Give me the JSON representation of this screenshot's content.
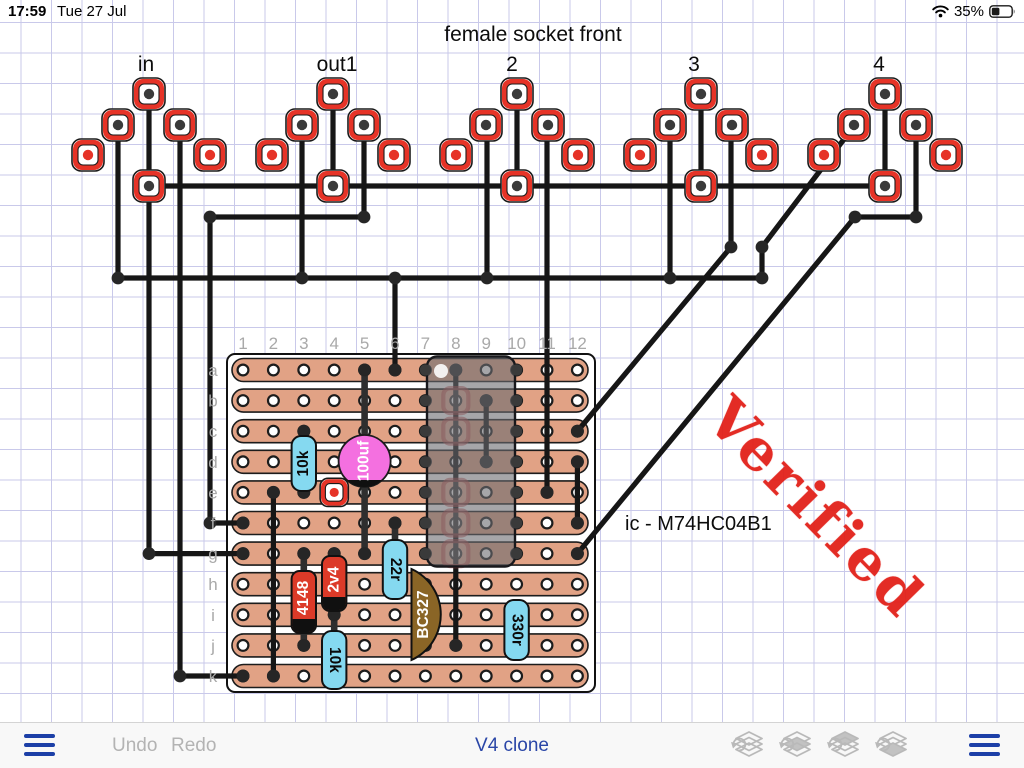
{
  "status_bar": {
    "time": "17:59",
    "date": "Tue 27 Jul",
    "battery_percent": "35%",
    "battery_level": 0.35
  },
  "header": {
    "title": "female socket front",
    "title_x": 533,
    "title_y": 41,
    "socket_labels": [
      {
        "text": "in",
        "x": 146
      },
      {
        "text": "out1",
        "x": 337
      },
      {
        "text": "2",
        "x": 512
      },
      {
        "text": "3",
        "x": 694
      },
      {
        "text": "4",
        "x": 879
      }
    ],
    "labels_y": 71
  },
  "annotations": {
    "ic_label": {
      "text": "ic - M74HC04B1",
      "x": 625,
      "y": 530
    },
    "stamp": {
      "text": "Verified",
      "color": "#e2211a",
      "angle": 45.5
    }
  },
  "toolbar": {
    "undo_label": "Undo",
    "redo_label": "Redo",
    "title": "V4 clone",
    "layer_buttons": [
      {
        "name": "layer-raise-to-top",
        "filled": -1
      },
      {
        "name": "layer-raise",
        "filled": 1
      },
      {
        "name": "layer-lower",
        "filled": 0
      },
      {
        "name": "layer-lower-to-bottom",
        "filled": 2
      }
    ]
  },
  "colors": {
    "grid": "#c9c9ea",
    "wire": "#161616",
    "lead": "#2e2e2e",
    "pad_red": "#e63327",
    "dot_dark": "#3a3a3a",
    "junction": "#262626",
    "strip": "#e1a285",
    "strip_edge": "#1c1c1c",
    "cyan": "#85d9f0",
    "comp_red": "#dc3a28",
    "cap_pink": "#f470e0",
    "transistor_brown": "#8a6526",
    "ic_gray": "rgba(106,106,112,0.6)",
    "label_gray": "#a9a9a9",
    "blue": "#1c3fa7",
    "toolbar_gray": "#b3b3b3"
  },
  "board": {
    "x": 227,
    "y": 354,
    "w": 368,
    "h": 338,
    "cols": [
      243,
      273.4,
      303.8,
      334.2,
      364.6,
      395,
      425.4,
      455.8,
      486.2,
      516.6,
      547,
      577.4
    ],
    "rows": [
      370,
      400.6,
      431.2,
      461.8,
      492.4,
      523,
      553.6,
      584.2,
      614.8,
      645.4,
      676
    ],
    "col_labels": [
      "1",
      "2",
      "3",
      "4",
      "5",
      "6",
      "7",
      "8",
      "9",
      "10",
      "11",
      "12"
    ],
    "row_labels": [
      "a",
      "b",
      "c",
      "d",
      "e",
      "f",
      "g",
      "h",
      "i",
      "j",
      "k"
    ],
    "col_label_y": 349,
    "row_label_x": 213
  },
  "circuit": {
    "socket_groups": [
      {
        "label": "in",
        "cx": 149
      },
      {
        "label": "out1",
        "cx": 333
      },
      {
        "label": "2",
        "cx": 517
      },
      {
        "label": "3",
        "cx": 701
      },
      {
        "label": "4",
        "cx": 885
      }
    ],
    "socket_rows": {
      "top_y": 94,
      "flank_y": 125,
      "wide_y": 155,
      "bottom_y": 186,
      "flank_dx": 31,
      "wide_dx": 61
    },
    "wires": [
      [
        [
          149,
          186
        ],
        [
          885,
          186
        ]
      ],
      [
        [
          149,
          94
        ],
        [
          149,
          186
        ]
      ],
      [
        [
          333,
          94
        ],
        [
          333,
          186
        ]
      ],
      [
        [
          517,
          94
        ],
        [
          517,
          186
        ]
      ],
      [
        [
          701,
          94
        ],
        [
          701,
          186
        ]
      ],
      [
        [
          885,
          94
        ],
        [
          885,
          186
        ]
      ],
      [
        [
          118,
          125
        ],
        [
          118,
          278
        ]
      ],
      [
        [
          118,
          278
        ],
        [
          762,
          278
        ]
      ],
      [
        [
          302,
          125
        ],
        [
          302,
          278
        ]
      ],
      [
        [
          487,
          125
        ],
        [
          487,
          278
        ]
      ],
      [
        [
          670,
          125
        ],
        [
          670,
          278
        ]
      ],
      [
        [
          395,
          278
        ],
        [
          395,
          370
        ]
      ],
      [
        [
          854,
          126
        ],
        [
          762,
          247
        ],
        [
          762,
          278
        ]
      ],
      [
        [
          364,
          125
        ],
        [
          364,
          217
        ],
        [
          210,
          217
        ],
        [
          210,
          523
        ],
        [
          243,
          523
        ]
      ],
      [
        [
          180,
          125
        ],
        [
          180,
          676
        ],
        [
          243,
          676
        ]
      ],
      [
        [
          149,
          186
        ],
        [
          149,
          553.6
        ],
        [
          243,
          553.6
        ]
      ],
      [
        [
          547,
          125
        ],
        [
          547,
          492.4
        ]
      ],
      [
        [
          731,
          125
        ],
        [
          731,
          247
        ],
        [
          577.4,
          431.2
        ]
      ],
      [
        [
          916,
          125
        ],
        [
          916,
          217
        ],
        [
          855,
          217
        ],
        [
          577.4,
          553.6
        ]
      ],
      [
        [
          273.4,
          492.4
        ],
        [
          273.4,
          676
        ]
      ],
      [
        [
          455.8,
          370
        ],
        [
          455.8,
          645.4
        ]
      ],
      [
        [
          486.2,
          400.6
        ],
        [
          486.2,
          461.8
        ]
      ],
      [
        [
          577.4,
          461.8
        ],
        [
          577.4,
          523
        ]
      ]
    ],
    "lead_wires": [
      [
        [
          364.6,
          370
        ],
        [
          364.6,
          553.6
        ]
      ],
      [
        [
          303.8,
          431.2
        ],
        [
          303.8,
          492.4
        ]
      ],
      [
        [
          303.8,
          553.6
        ],
        [
          303.8,
          645.4
        ]
      ],
      [
        [
          334.2,
          553.6
        ],
        [
          334.2,
          614.8
        ]
      ],
      [
        [
          395,
          523
        ],
        [
          395,
          584.2
        ]
      ],
      [
        [
          334.2,
          614.8
        ],
        [
          334.2,
          676
        ]
      ]
    ],
    "junction_dots": [
      [
        364,
        217
      ],
      [
        210,
        217
      ],
      [
        210,
        523
      ],
      [
        243,
        523
      ],
      [
        149,
        553.6
      ],
      [
        243,
        553.6
      ],
      [
        180,
        676
      ],
      [
        243,
        676
      ],
      [
        118,
        278
      ],
      [
        302,
        278
      ],
      [
        395,
        278
      ],
      [
        487,
        278
      ],
      [
        670,
        278
      ],
      [
        762,
        247
      ],
      [
        762,
        278
      ],
      [
        916,
        217
      ],
      [
        855,
        217
      ],
      [
        731,
        247
      ],
      [
        364.6,
        370
      ],
      [
        395,
        370
      ],
      [
        455.8,
        370
      ],
      [
        455.8,
        645.4
      ],
      [
        486.2,
        400.6
      ],
      [
        486.2,
        461.8
      ],
      [
        577.4,
        431.2
      ],
      [
        577.4,
        461.8
      ],
      [
        577.4,
        523
      ],
      [
        577.4,
        553.6
      ],
      [
        547,
        492.4
      ],
      [
        303.8,
        431.2
      ],
      [
        303.8,
        492.4
      ],
      [
        273.4,
        492.4
      ],
      [
        273.4,
        676
      ],
      [
        303.8,
        553.6
      ],
      [
        303.8,
        645.4
      ],
      [
        334.2,
        553.6
      ],
      [
        334.2,
        614.8
      ],
      [
        395,
        523
      ],
      [
        364.6,
        553.6
      ]
    ],
    "ic": {
      "x": 427,
      "y": 356.5,
      "w": 88,
      "h": 210,
      "pin_cols": [
        425.4,
        516.6
      ],
      "pin_rows": [
        370,
        400.6,
        431.2,
        461.8,
        492.4,
        523,
        553.6
      ],
      "pin1_dot": [
        441,
        371
      ],
      "hidden_pads_col": 455.8,
      "hidden_pads_rows": [
        400.6,
        431.2,
        492.4,
        523,
        553.6
      ]
    },
    "components": [
      {
        "type": "resistor",
        "label": "10k",
        "x": 303.8,
        "top": 436,
        "bottom": 491,
        "text_rot": -90
      },
      {
        "type": "cap",
        "label": "100uf",
        "cx": 364.6,
        "cy": 461,
        "r": 26,
        "text_rot": -90
      },
      {
        "type": "pad",
        "x": 334.2,
        "y": 492.4
      },
      {
        "type": "diode",
        "label": "4148",
        "x": 303.8,
        "top": 571,
        "bottom": 633,
        "text_rot": -90
      },
      {
        "type": "diode",
        "label": "2v4",
        "x": 334.2,
        "top": 556,
        "bottom": 611,
        "text_rot": -90
      },
      {
        "type": "resistor",
        "label": "22r",
        "x": 395,
        "top": 540,
        "bottom": 599,
        "text_rot": 90
      },
      {
        "type": "transistor",
        "label": "BC327",
        "x": 411.5,
        "top": 569,
        "bottom": 660,
        "bulge": 31,
        "text_rot": -90
      },
      {
        "type": "resistor",
        "label": "330r",
        "x": 516.6,
        "top": 600,
        "bottom": 660,
        "text_rot": 90
      },
      {
        "type": "resistor",
        "label": "10k",
        "x": 334.2,
        "top": 631,
        "bottom": 689,
        "text_rot": 90
      }
    ]
  }
}
